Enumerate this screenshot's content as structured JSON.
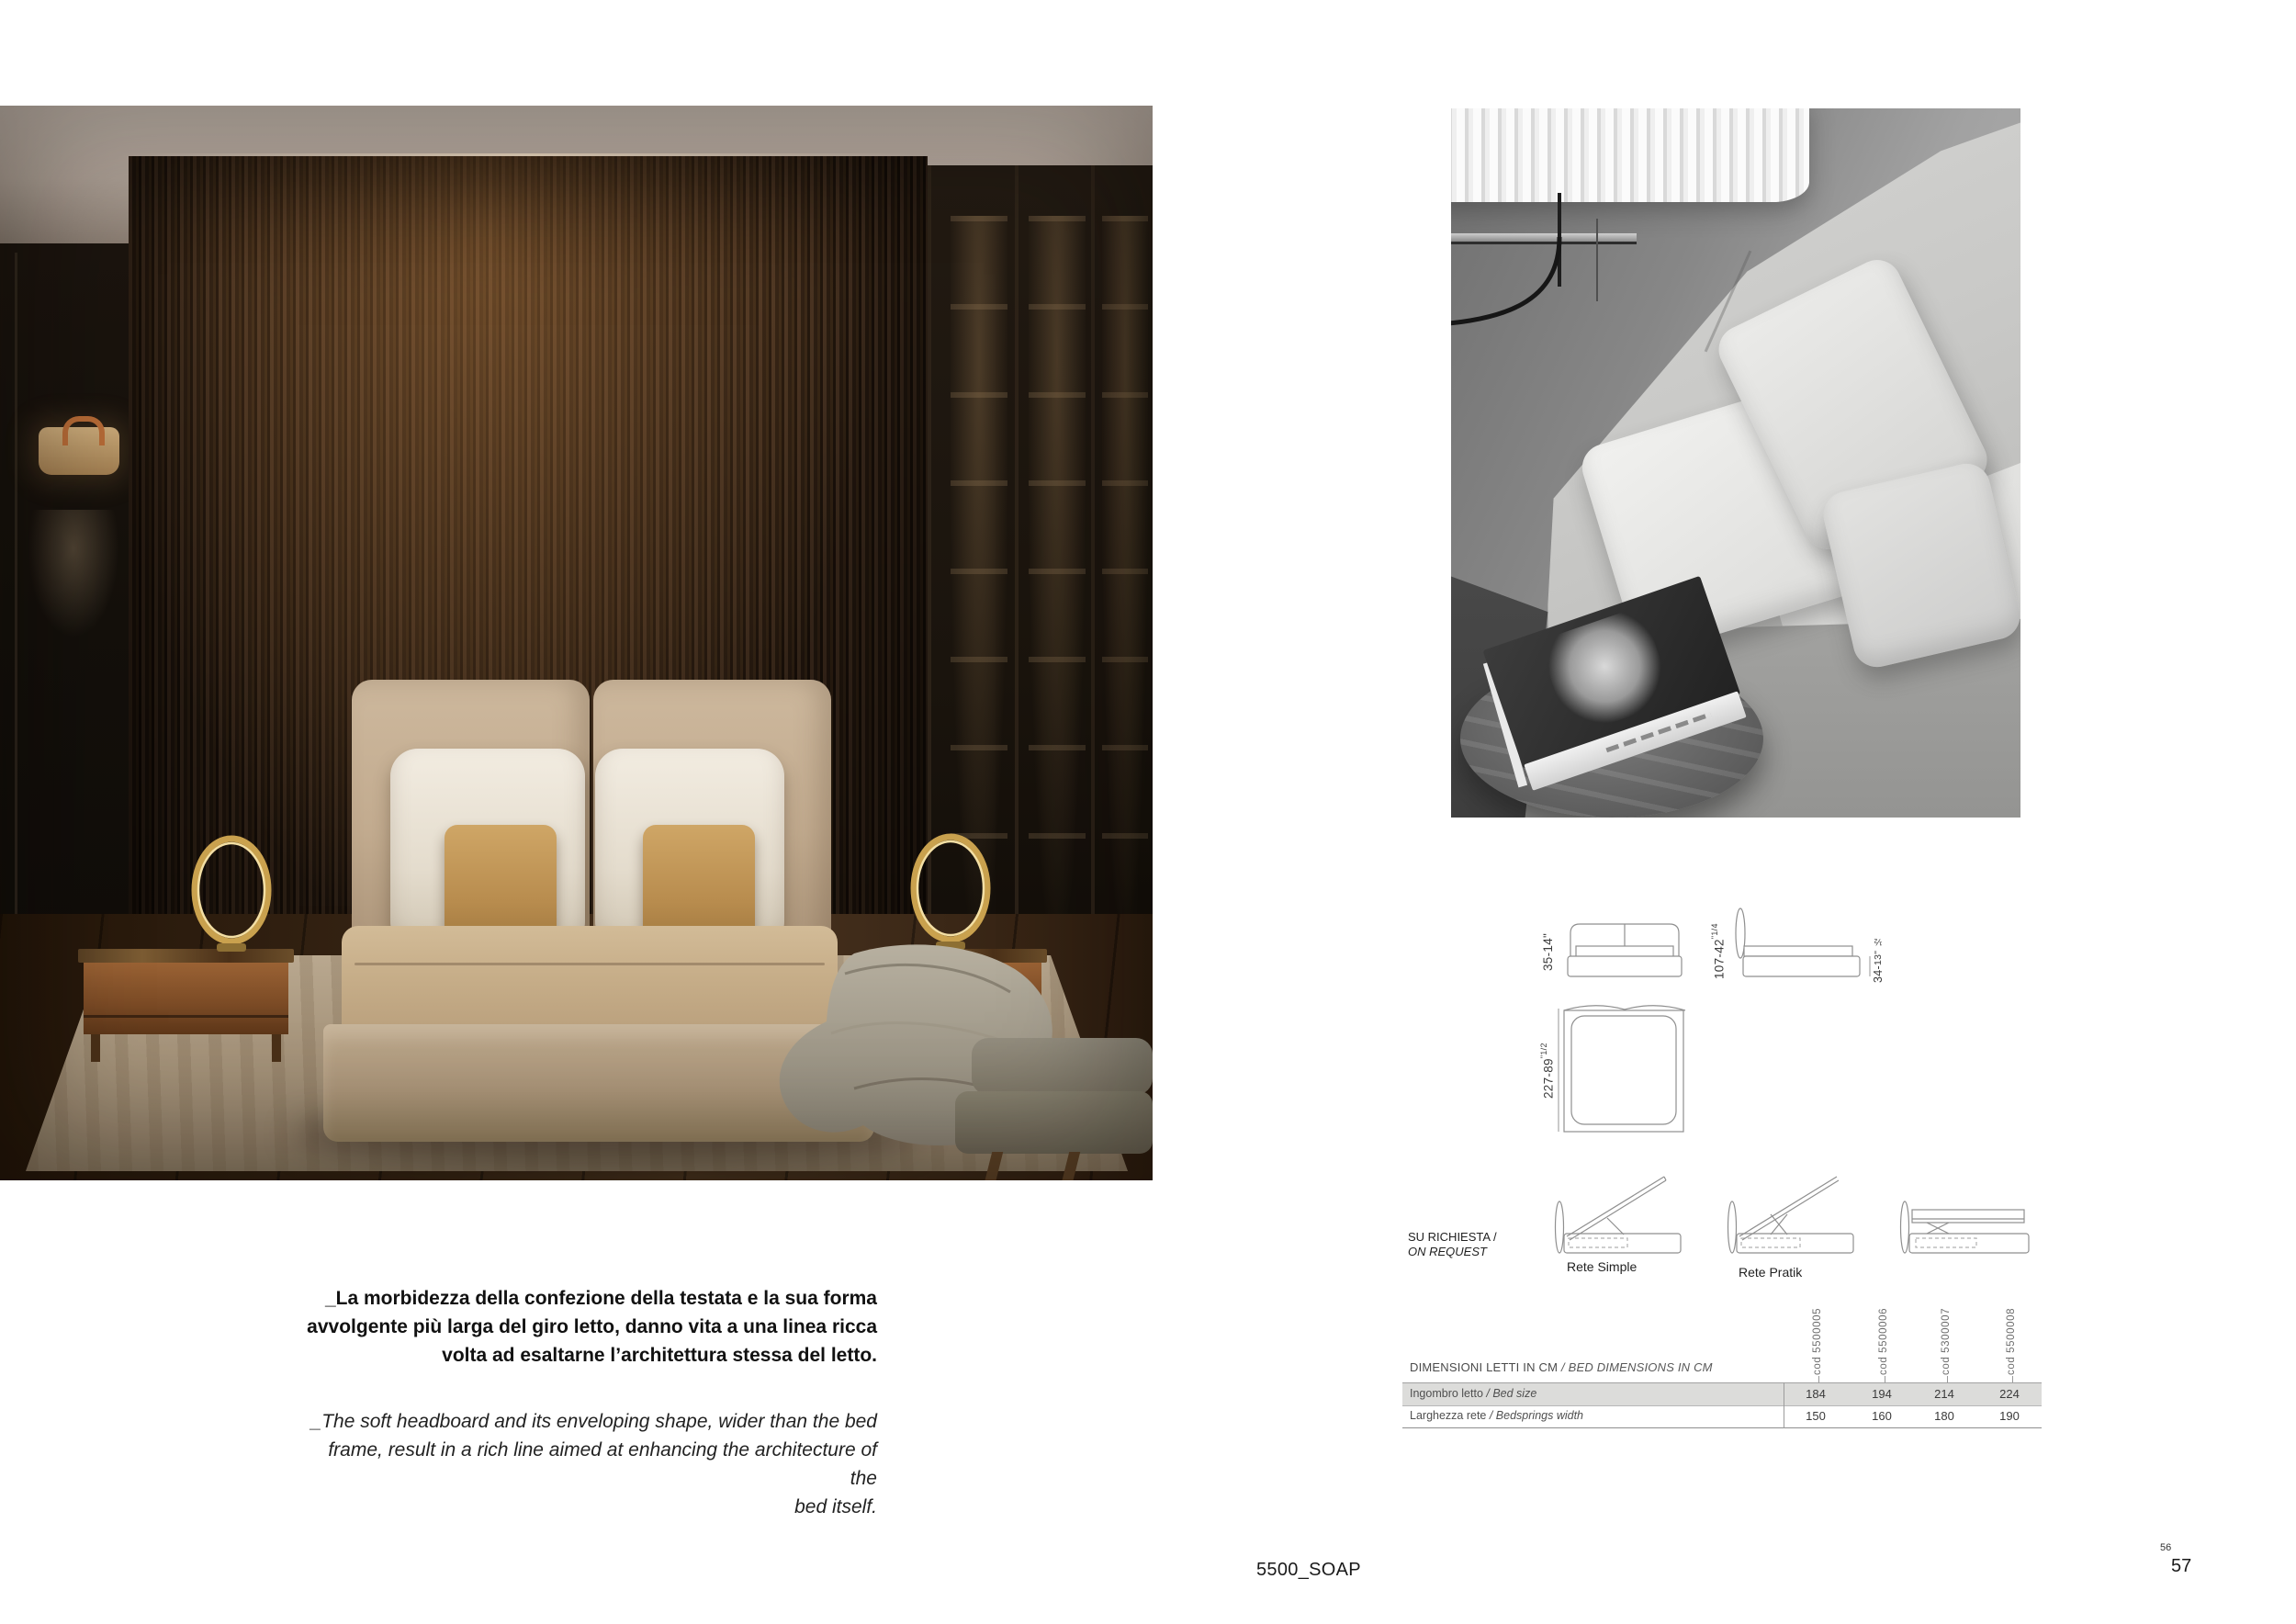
{
  "caption": {
    "it_lines": [
      "_La morbidezza della confezione della testata e la sua forma",
      "avvolgente più larga del giro letto, danno vita a una linea ricca",
      "volta ad esaltarne l’architettura stessa del letto."
    ],
    "en_lines": [
      "_The soft headboard and its enveloping shape, wider than the bed",
      "frame, result in a rich line aimed at enhancing the architecture of the",
      "bed itself."
    ]
  },
  "drawings": {
    "front_label": {
      "main": "35-14\""
    },
    "plan_label": {
      "main": "227-89",
      "sup": "\"1/2"
    },
    "side_label": {
      "main": "107-42",
      "sup": "\"1/4"
    },
    "base_label": {
      "main": "34-",
      "small": "13\" ½"
    }
  },
  "on_request": {
    "line1": "SU RICHIESTA /",
    "line2": "ON REQUEST",
    "rete_simple": "Rete Simple",
    "rete_pratik": "Rete Pratik"
  },
  "table": {
    "title_it": "DIMENSIONI LETTI IN CM",
    "title_en": "/ BED DIMENSIONS IN CM",
    "columns": [
      "cod 5500005",
      "cod 5500006",
      "cod 5300007",
      "cod 5500008"
    ],
    "rows": [
      {
        "label_it": "Ingombro letto ",
        "label_en": "/ Bed size",
        "values": [
          "184",
          "194",
          "214",
          "224"
        ]
      },
      {
        "label_it": "Larghezza rete ",
        "label_en": "/ Bedsprings width",
        "values": [
          "150",
          "160",
          "180",
          "190"
        ]
      }
    ]
  },
  "footer": {
    "product": "5500_SOAP",
    "page_small": "56",
    "page": "57"
  },
  "colors": {
    "accent_gold": "#c9a14e",
    "wood_dark": "#241709",
    "fabric_beige": "#c7b197"
  }
}
